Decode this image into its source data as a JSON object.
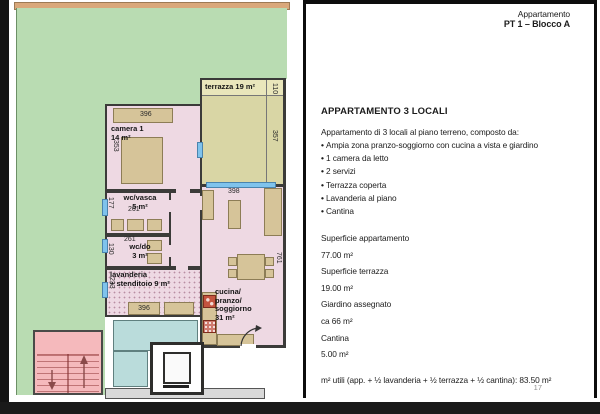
{
  "document": {
    "page_number": "17"
  },
  "header": {
    "label": "Appartamento",
    "unit": "PT 1 – Blocco A"
  },
  "panel": {
    "title": "APPARTAMENTO 3 LOCALI",
    "intro": "Appartamento di 3 locali al piano terreno, composto da:",
    "bullets": [
      "Ampia zona pranzo-soggiorno con cucina a vista e giardino",
      "1 camera da letto",
      "2 servizi",
      "Terrazza coperta",
      "Lavanderia al piano",
      "Cantina"
    ],
    "areas": [
      {
        "label": "Superficie appartamento",
        "value": "77.00 m²"
      },
      {
        "label": "Superficie terrazza",
        "value": "19.00 m²"
      },
      {
        "label": "Giardino assegnato",
        "value": "ca 66 m²"
      },
      {
        "label": "Cantina",
        "value": "5.00 m²"
      }
    ],
    "footer": "m² utili (app. + ½ lavanderia + ½ terrazza + ½ cantina): 83.50 m²"
  },
  "plan": {
    "rooms": {
      "terrazza": {
        "label": "terrazza 19 m²"
      },
      "camera": {
        "name": "camera 1",
        "area": "14 m²"
      },
      "wc_vasca": {
        "name": "wc/vasca",
        "area": "5 m²"
      },
      "wc_do": {
        "name": "wc/do",
        "area": "3 m²"
      },
      "lavanderia": {
        "name": "lavanderia",
        "area": "+ stenditoio 9 m²"
      },
      "living": {
        "line1": "cucina/",
        "line2": "pranzo/",
        "line3": "soggiorno",
        "area": "31 m²"
      }
    },
    "dims": {
      "camera_width": "396",
      "camera_height": "353",
      "wc_vasca_height": "177",
      "wc_vasca_width": "261",
      "wc_do_width": "261",
      "wc_do_height": "130",
      "lavanderia_height": "233",
      "lavanderia_width": "396",
      "living_width": "398",
      "living_height": "761",
      "terrazza_depth": "110",
      "terrazza_side": "357"
    },
    "colors": {
      "garden": "#b9dcb2",
      "garden_border": "#d9a87b",
      "terrace": "#d9d6a5",
      "room_pink": "#eed9e3",
      "stairs_pink": "#f5b9bc",
      "teal": "#badcdb",
      "window_blue": "#7fc3ec",
      "furniture_tan": "#d6c499"
    }
  }
}
